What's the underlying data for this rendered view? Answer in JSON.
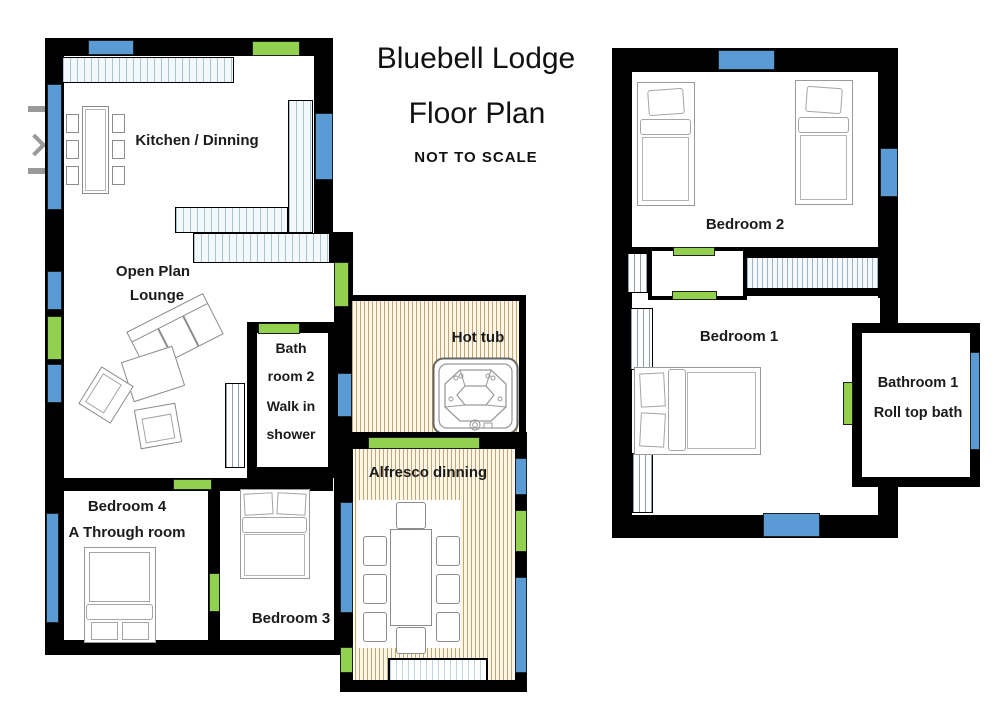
{
  "title": {
    "name": "Bluebell Lodge",
    "subtitle": "Floor Plan",
    "note": "NOT TO SCALE"
  },
  "colors": {
    "wall": "#000000",
    "window_blue": "#5b9bd5",
    "door_green": "#92d050",
    "deck_stripe": "#c5a569",
    "counter_stripe": "#a9c2d6"
  },
  "ground_floor": {
    "kitchen_label": "Kitchen / Dinning",
    "lounge_label_1": "Open Plan",
    "lounge_label_2": "Lounge",
    "bathroom2_lines": [
      "Bath",
      "room 2",
      "Walk in",
      "shower"
    ],
    "bedroom4_label": "Bedroom 4",
    "bedroom4_sublabel": "A Through room",
    "bedroom3_label": "Bedroom 3",
    "hot_tub_label": "Hot tub",
    "alfresco_label": "Alfresco dinning"
  },
  "first_floor": {
    "bedroom2_label": "Bedroom 2",
    "bedroom1_label": "Bedroom 1",
    "bathroom1_label": "Bathroom 1",
    "bathroom1_sublabel": "Roll top bath"
  }
}
